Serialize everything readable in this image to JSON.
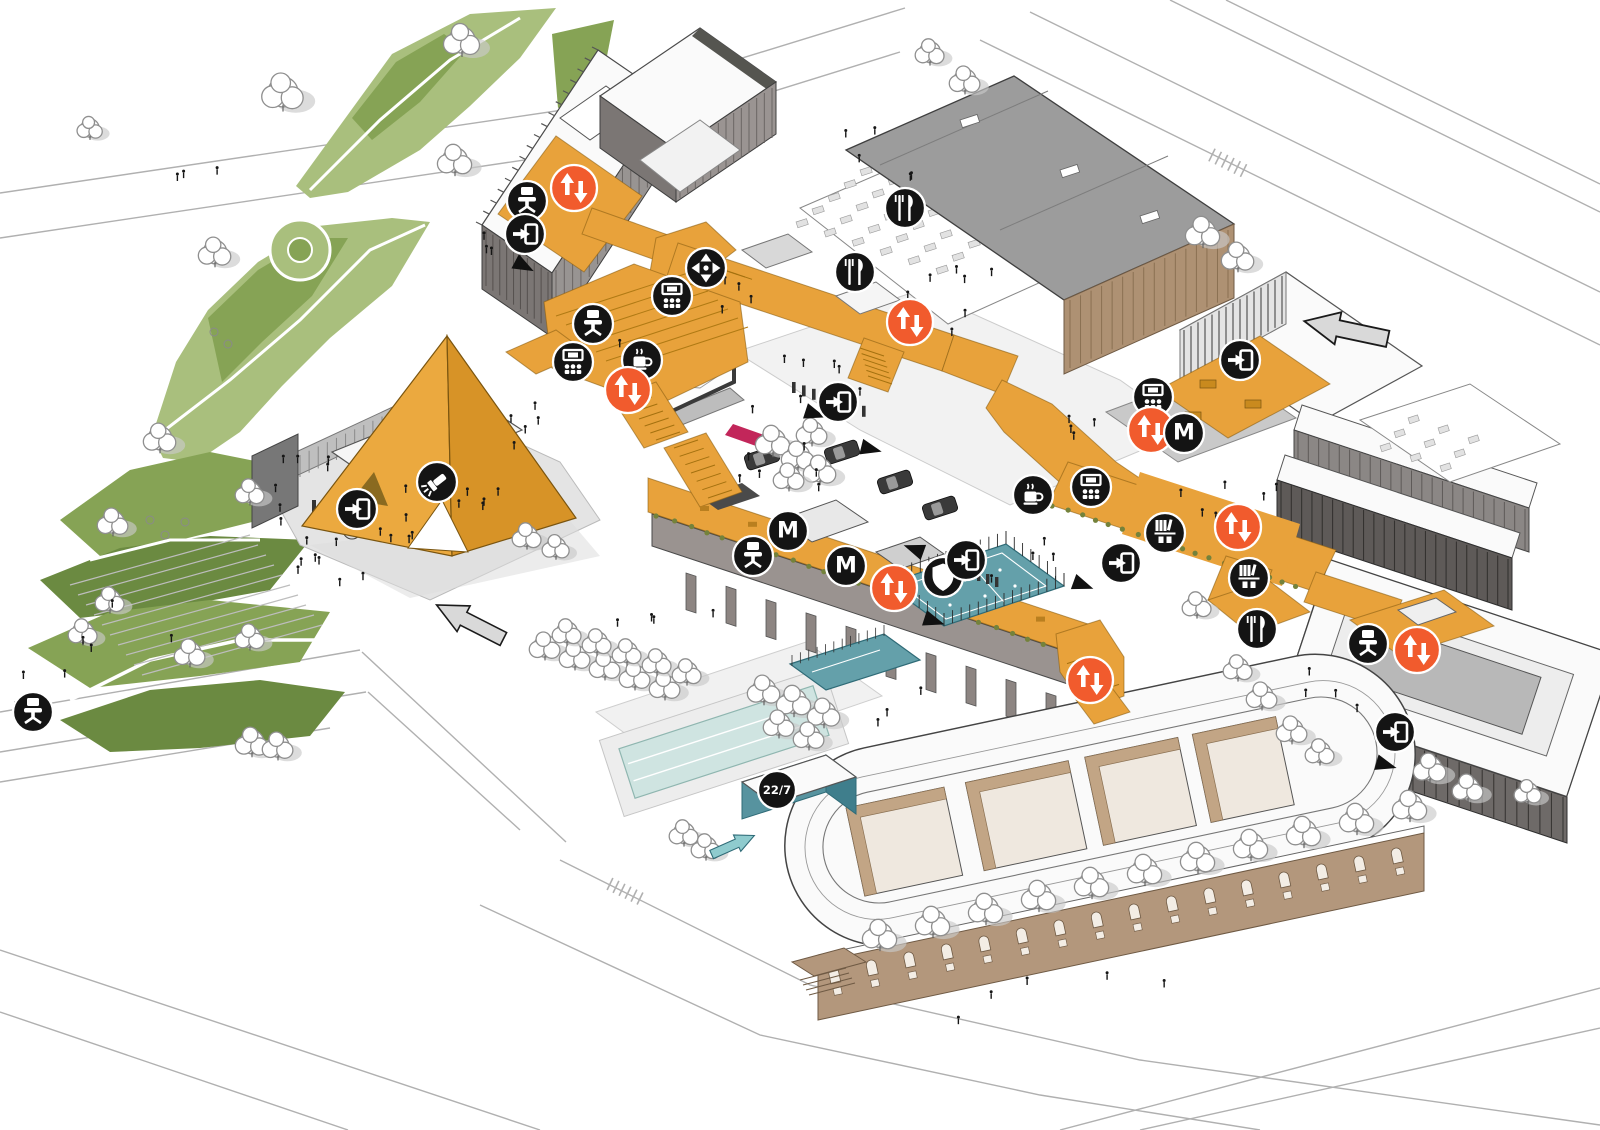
{
  "document": {
    "title": "Campus masterplan axonometric diagram",
    "background": "#ffffff"
  },
  "labels": {
    "metro": "M",
    "open_hours": "22/7"
  },
  "palette": {
    "route_orange": "#E8A23B",
    "route_orange_dark": "#D79327",
    "route_edge": "#8a5f12",
    "accent_orange": "#F15B2D",
    "badge_black": "#141414",
    "glyph_white": "#ffffff",
    "park_light": "#A9BF7D",
    "park_mid": "#86A355",
    "park_dark": "#6B8A41",
    "pool_teal": "#CFE4E1",
    "court_teal": "#64A0AA",
    "teal_wall": "#57939F",
    "teal_dark": "#2F6B77",
    "tan": "#B3977C",
    "tan_dark": "#6f5a44",
    "tan_light": "#C2A585",
    "bldg_gray": "#8D8582",
    "bldg_dark": "#5E5A58",
    "roof_white": "#FAFAFA",
    "ground": "#E7E7E7",
    "road": "#B0B0B0",
    "shadow": "#C9C9C9",
    "screen_frame": "#3A3A3A",
    "carpet_red": "#C2265A",
    "arrow_gray": "#D9D9D9",
    "planting_olive": "#74823B"
  },
  "marker_styles": {
    "black_badge": {
      "fill": "#141414",
      "stroke": "#ffffff",
      "radius": 20
    },
    "elevator_badge": {
      "fill": "#F15B2D",
      "stroke": "#ffffff",
      "radius": 23
    },
    "hours_badge": {
      "fill": "#141414",
      "stroke": "#ffffff",
      "radius": 19
    }
  },
  "markers": [
    {
      "type": "elevator",
      "x": 574,
      "y": 188
    },
    {
      "type": "workspace",
      "x": 527,
      "y": 201
    },
    {
      "type": "entrance",
      "x": 525,
      "y": 234
    },
    {
      "type": "circulation",
      "x": 706,
      "y": 268
    },
    {
      "type": "auditorium",
      "x": 672,
      "y": 296
    },
    {
      "type": "restaurant",
      "x": 905,
      "y": 208
    },
    {
      "type": "restaurant",
      "x": 855,
      "y": 272
    },
    {
      "type": "elevator",
      "x": 910,
      "y": 322
    },
    {
      "type": "workspace",
      "x": 593,
      "y": 324
    },
    {
      "type": "auditorium",
      "x": 573,
      "y": 362
    },
    {
      "type": "cafe",
      "x": 642,
      "y": 360
    },
    {
      "type": "elevator",
      "x": 628,
      "y": 390
    },
    {
      "type": "spotlight",
      "x": 437,
      "y": 482
    },
    {
      "type": "entrance",
      "x": 357,
      "y": 509
    },
    {
      "type": "entrance",
      "x": 838,
      "y": 402
    },
    {
      "type": "metro",
      "x": 788,
      "y": 531
    },
    {
      "type": "workspace",
      "x": 753,
      "y": 556
    },
    {
      "type": "metro",
      "x": 846,
      "y": 566
    },
    {
      "type": "elevator",
      "x": 894,
      "y": 588
    },
    {
      "type": "security",
      "x": 943,
      "y": 577
    },
    {
      "type": "entrance",
      "x": 966,
      "y": 560
    },
    {
      "type": "cafe",
      "x": 1033,
      "y": 495
    },
    {
      "type": "auditorium",
      "x": 1091,
      "y": 487
    },
    {
      "type": "auditorium",
      "x": 1153,
      "y": 397
    },
    {
      "type": "elevator",
      "x": 1151,
      "y": 430
    },
    {
      "type": "metro",
      "x": 1184,
      "y": 433
    },
    {
      "type": "entrance",
      "x": 1240,
      "y": 360
    },
    {
      "type": "elevator",
      "x": 1238,
      "y": 527
    },
    {
      "type": "library",
      "x": 1165,
      "y": 533
    },
    {
      "type": "library",
      "x": 1249,
      "y": 578
    },
    {
      "type": "entrance",
      "x": 1121,
      "y": 563
    },
    {
      "type": "restaurant",
      "x": 1257,
      "y": 629
    },
    {
      "type": "workspace",
      "x": 1368,
      "y": 644
    },
    {
      "type": "elevator",
      "x": 1417,
      "y": 650
    },
    {
      "type": "entrance",
      "x": 1395,
      "y": 732
    },
    {
      "type": "elevator",
      "x": 1090,
      "y": 680
    },
    {
      "type": "hours",
      "x": 777,
      "y": 790
    },
    {
      "type": "workspace",
      "x": 33,
      "y": 712
    }
  ],
  "arrows": {
    "entry_large": [
      {
        "x": 1346,
        "y": 330,
        "rotation": 192,
        "scale": 0.82
      },
      {
        "x": 470,
        "y": 622,
        "rotation": 207,
        "scale": 0.72
      }
    ],
    "entry_teal": {
      "x": 733,
      "y": 845,
      "rotation": -24,
      "scale": 0.45
    },
    "wayfinding_small": [
      {
        "x": 524,
        "y": 266,
        "rotation": 28
      },
      {
        "x": 815,
        "y": 414,
        "rotation": 18
      },
      {
        "x": 871,
        "y": 449,
        "rotation": 14
      },
      {
        "x": 914,
        "y": 549,
        "rotation": 200
      },
      {
        "x": 934,
        "y": 621,
        "rotation": 18
      },
      {
        "x": 1083,
        "y": 585,
        "rotation": 20
      },
      {
        "x": 1386,
        "y": 765,
        "rotation": 16
      }
    ]
  }
}
